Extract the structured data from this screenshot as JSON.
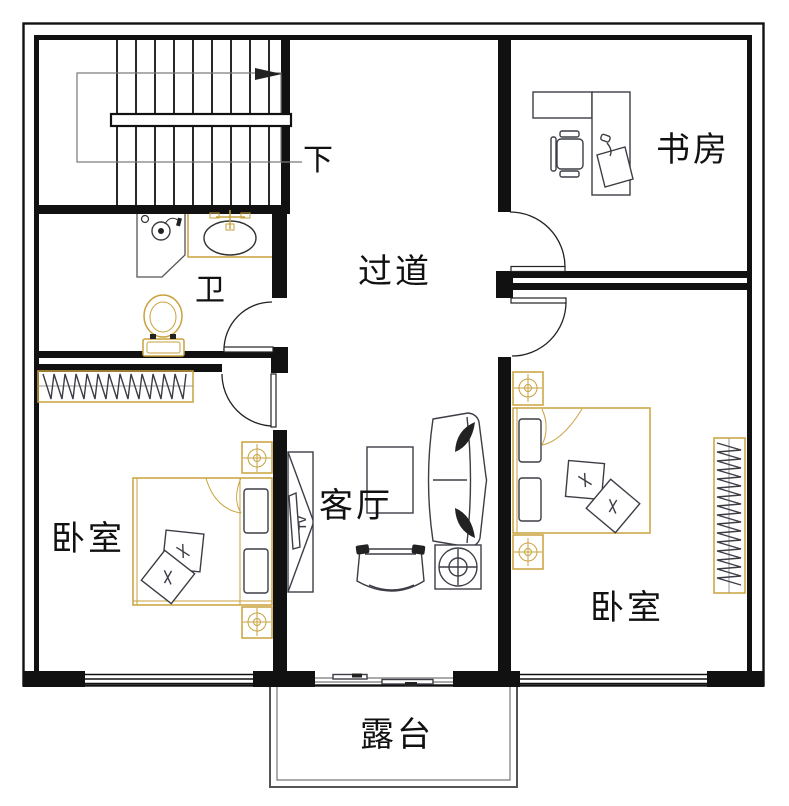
{
  "plan": {
    "rooms": {
      "study": {
        "label": "书房"
      },
      "hallway": {
        "label": "过道"
      },
      "bathroom": {
        "label": "卫"
      },
      "bedroom_left": {
        "label": "卧室"
      },
      "living_room": {
        "label": "客厅"
      },
      "bedroom_right": {
        "label": "卧室"
      },
      "terrace": {
        "label": "露台"
      }
    },
    "stairs": {
      "direction_label": "下"
    },
    "tv_cabinet": {
      "label": "TV"
    }
  },
  "colors": {
    "wall": "#111111",
    "line": "#3d3d46",
    "accent": "#c9a23d",
    "muted": "#777777",
    "bg": "#ffffff"
  }
}
